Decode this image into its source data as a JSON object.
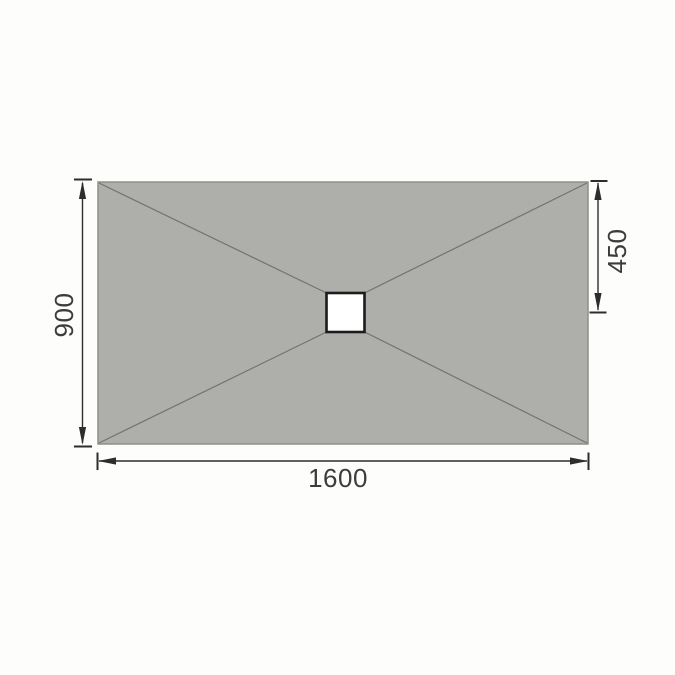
{
  "diagram": {
    "labels": {
      "tray_width": "1600",
      "tray_height": "900",
      "drain_offset_from_top": "450"
    },
    "colors": {
      "background": "#fdfdfc",
      "tray_fill": "#aeaeaa",
      "tray_edge": "#8f8f8b",
      "fall_line": "#73736f",
      "drain_fill": "#ffffff",
      "drain_border": "#1c1c1c",
      "dimension_line": "#2d2d2d",
      "label_text": "#3c3c3c"
    }
  }
}
